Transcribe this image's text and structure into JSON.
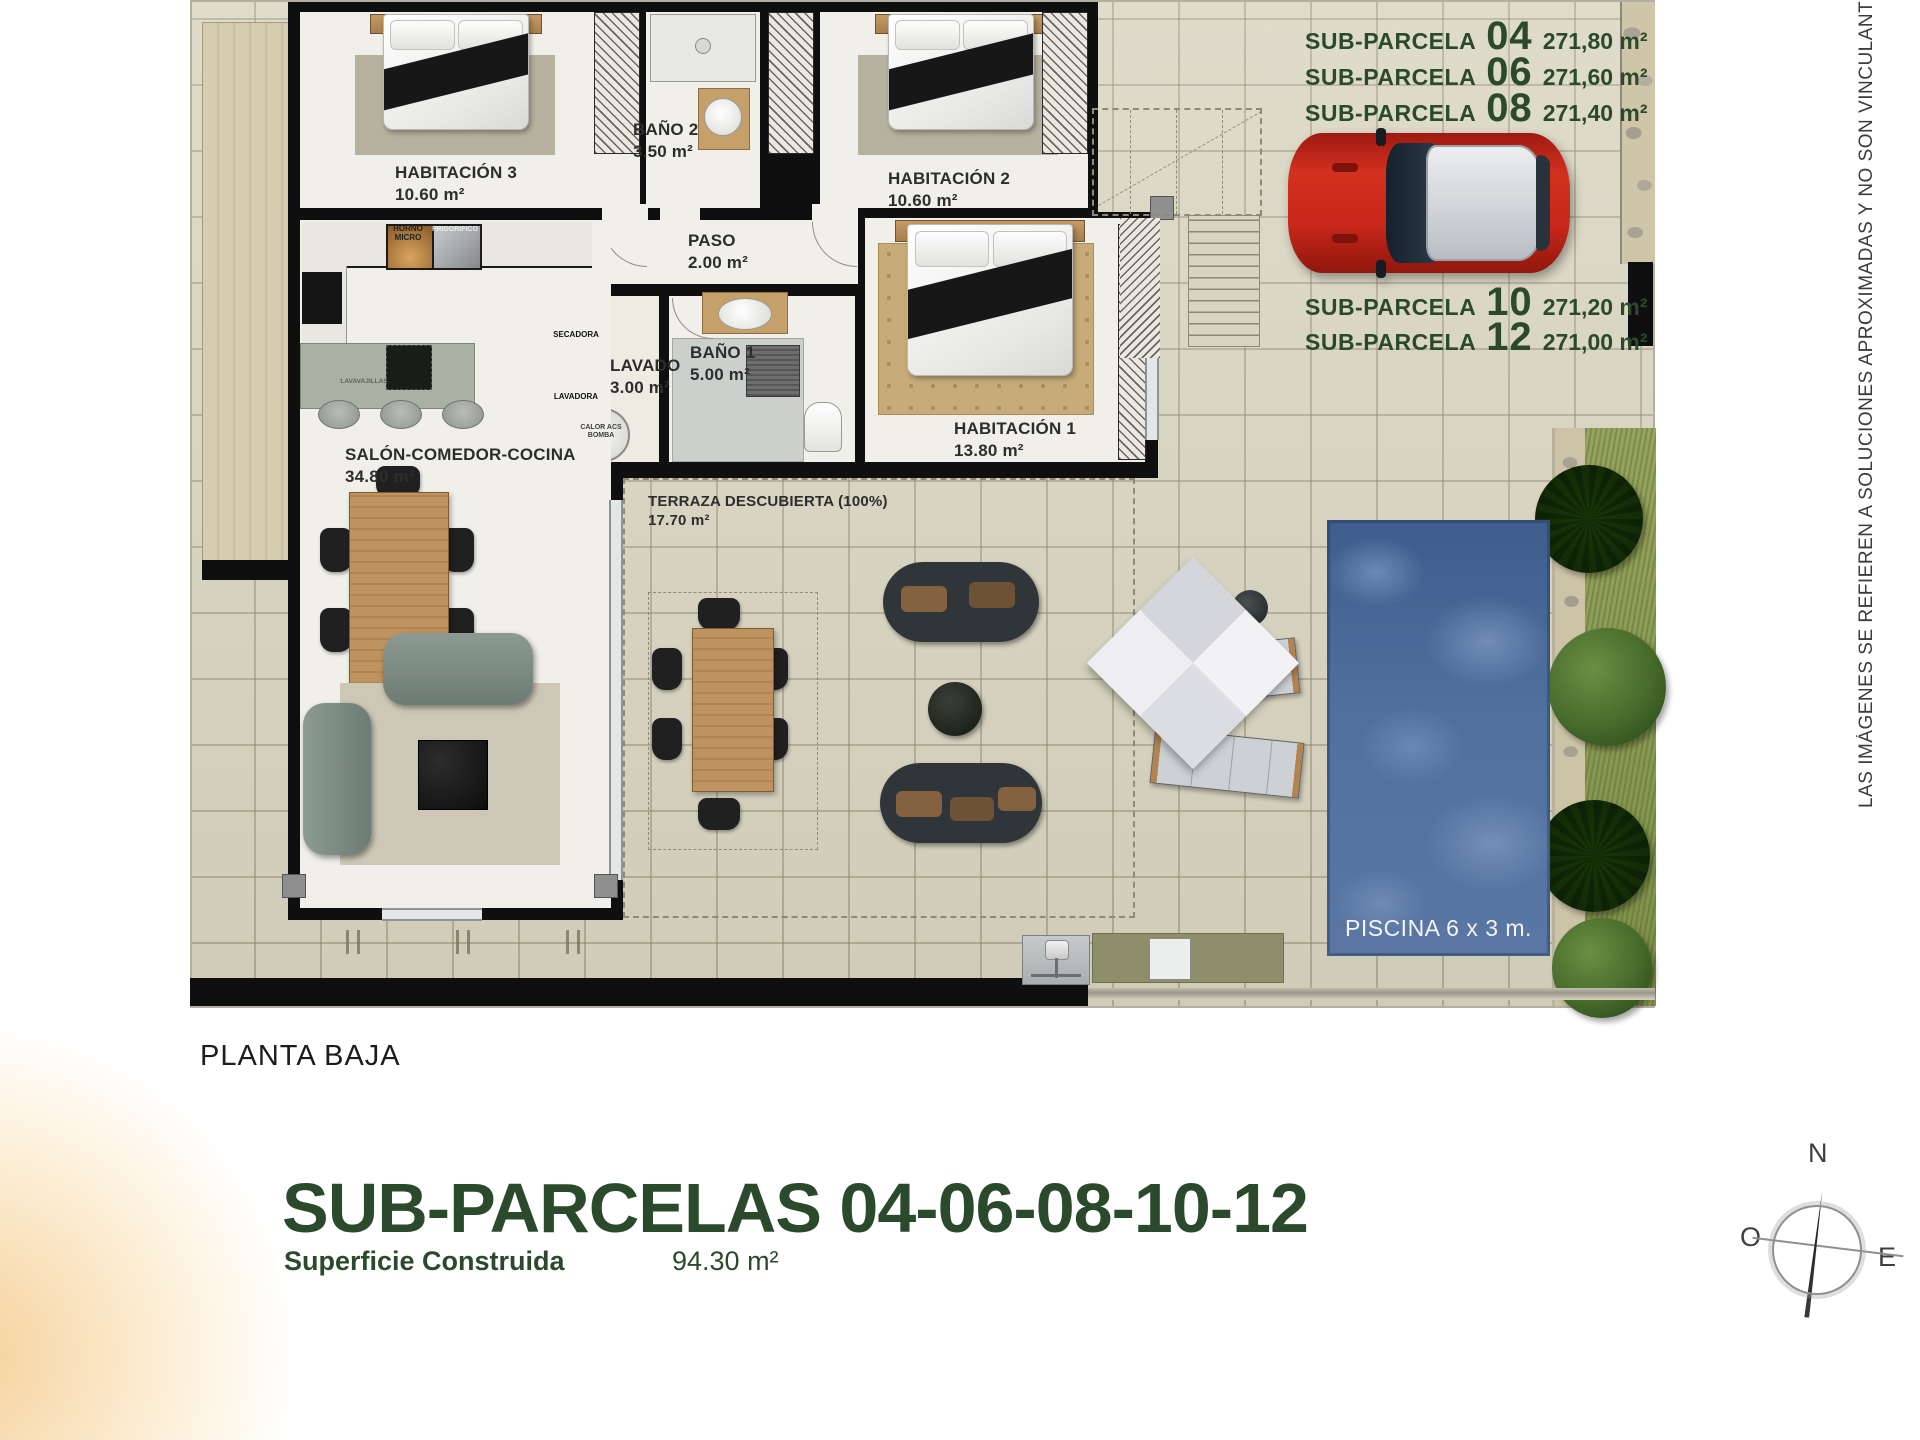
{
  "subparcelas": {
    "top": [
      {
        "label": "SUB-PARCELA",
        "num": "04",
        "area": "271,80 m²"
      },
      {
        "label": "SUB-PARCELA",
        "num": "06",
        "area": "271,60 m²"
      },
      {
        "label": "SUB-PARCELA",
        "num": "08",
        "area": "271,40 m²"
      }
    ],
    "bottom": [
      {
        "label": "SUB-PARCELA",
        "num": "10",
        "area": "271,20 m²"
      },
      {
        "label": "SUB-PARCELA",
        "num": "12",
        "area": "271,00 m²"
      }
    ]
  },
  "rooms": {
    "hab3": {
      "name": "HABITACIÓN 3",
      "area": "10.60 m²"
    },
    "bano2": {
      "name": "BAÑO 2",
      "area": "3.50 m²"
    },
    "hab2": {
      "name": "HABITACIÓN 2",
      "area": "10.60 m²"
    },
    "paso": {
      "name": "PASO",
      "area": "2.00 m²"
    },
    "lavado": {
      "name": "LAVADO",
      "area": "3.00 m²"
    },
    "bano1": {
      "name": "BAÑO 1",
      "area": "5.00 m²"
    },
    "hab1": {
      "name": "HABITACIÓN 1",
      "area": "13.80 m²"
    },
    "salon": {
      "name": "SALÓN-COMEDOR-COCINA",
      "area": "34.80 m²"
    },
    "terraza": {
      "name": "TERRAZA DESCUBIERTA (100%)",
      "area": "17.70 m²"
    },
    "piscina": {
      "name": "PISCINA 6 x 3 m."
    }
  },
  "appliances": {
    "horno": "HORNO\nMICRO",
    "frigo": "FRIGORIFICO",
    "lavavajillas": "LAVAVAJILLAS",
    "secadora": "SECADORA",
    "lavadora": "LAVADORA",
    "caldera": "CALOR ACS\nBOMBA"
  },
  "footer": {
    "plan_label": "PLANTA BAJA",
    "title": "SUB-PARCELAS 04-06-08-10-12",
    "superficie_label": "Superficie Construida",
    "superficie_value": "94.30 m²"
  },
  "disclaimer": "LAS IMÁGENES SE REFIEREN A SOLUCIONES APROXIMADAS Y NO SON VINCULANTES AL PROYECT",
  "compass": {
    "n": "N",
    "o": "O",
    "e": "E"
  },
  "colors": {
    "accent_green": "#2b4a2b",
    "pool_blue": "#52719f",
    "car_red": "#c5271b",
    "wall_black": "#0f0f0f"
  }
}
